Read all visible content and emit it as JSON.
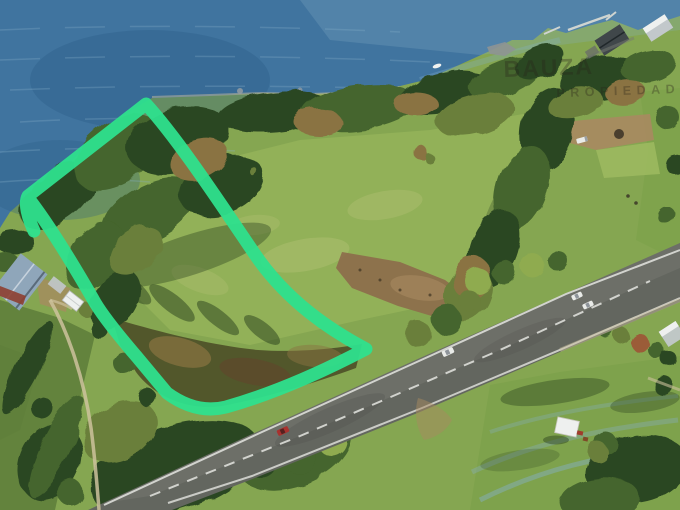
{
  "watermark": {
    "line1": "BAUZA",
    "line2": "PROPIEDADES"
  },
  "colors": {
    "water_deep": "#2c5c86",
    "water_mid": "#40749f",
    "water_light": "#86afc9",
    "grass_base": "#85a651",
    "grass_bright": "#9cb95f",
    "grass_pale": "#b7c478",
    "grass_dark": "#5d7d3a",
    "grass_lawn": "#7da24b",
    "tree_dark": "#2c4722",
    "tree_green": "#44652d",
    "tree_olive": "#6a7f3a",
    "tree_light": "#8fab4f",
    "tree_brown": "#8a7342",
    "tree_rust": "#9b5c38",
    "scrub": "#4c4f27",
    "dirt": "#8d6f4c",
    "dirt_light": "#a88a60",
    "road": "#63665f",
    "road_light": "#83867e",
    "marking": "#e4e5e0",
    "track": "#cdc29c",
    "sand": "#c6bb9e",
    "dock": "#cfd4d0",
    "roof_blue": "#8fa6ba",
    "roof_dark": "#40474a",
    "roof_gray": "#c2c8cb",
    "roof_white": "#eef0ef",
    "deck_red": "#8e3f31",
    "car_red": "#a8322f",
    "car_white": "#e9ebe8",
    "outline": "#2ee08d",
    "watermark": "#2b241a"
  }
}
